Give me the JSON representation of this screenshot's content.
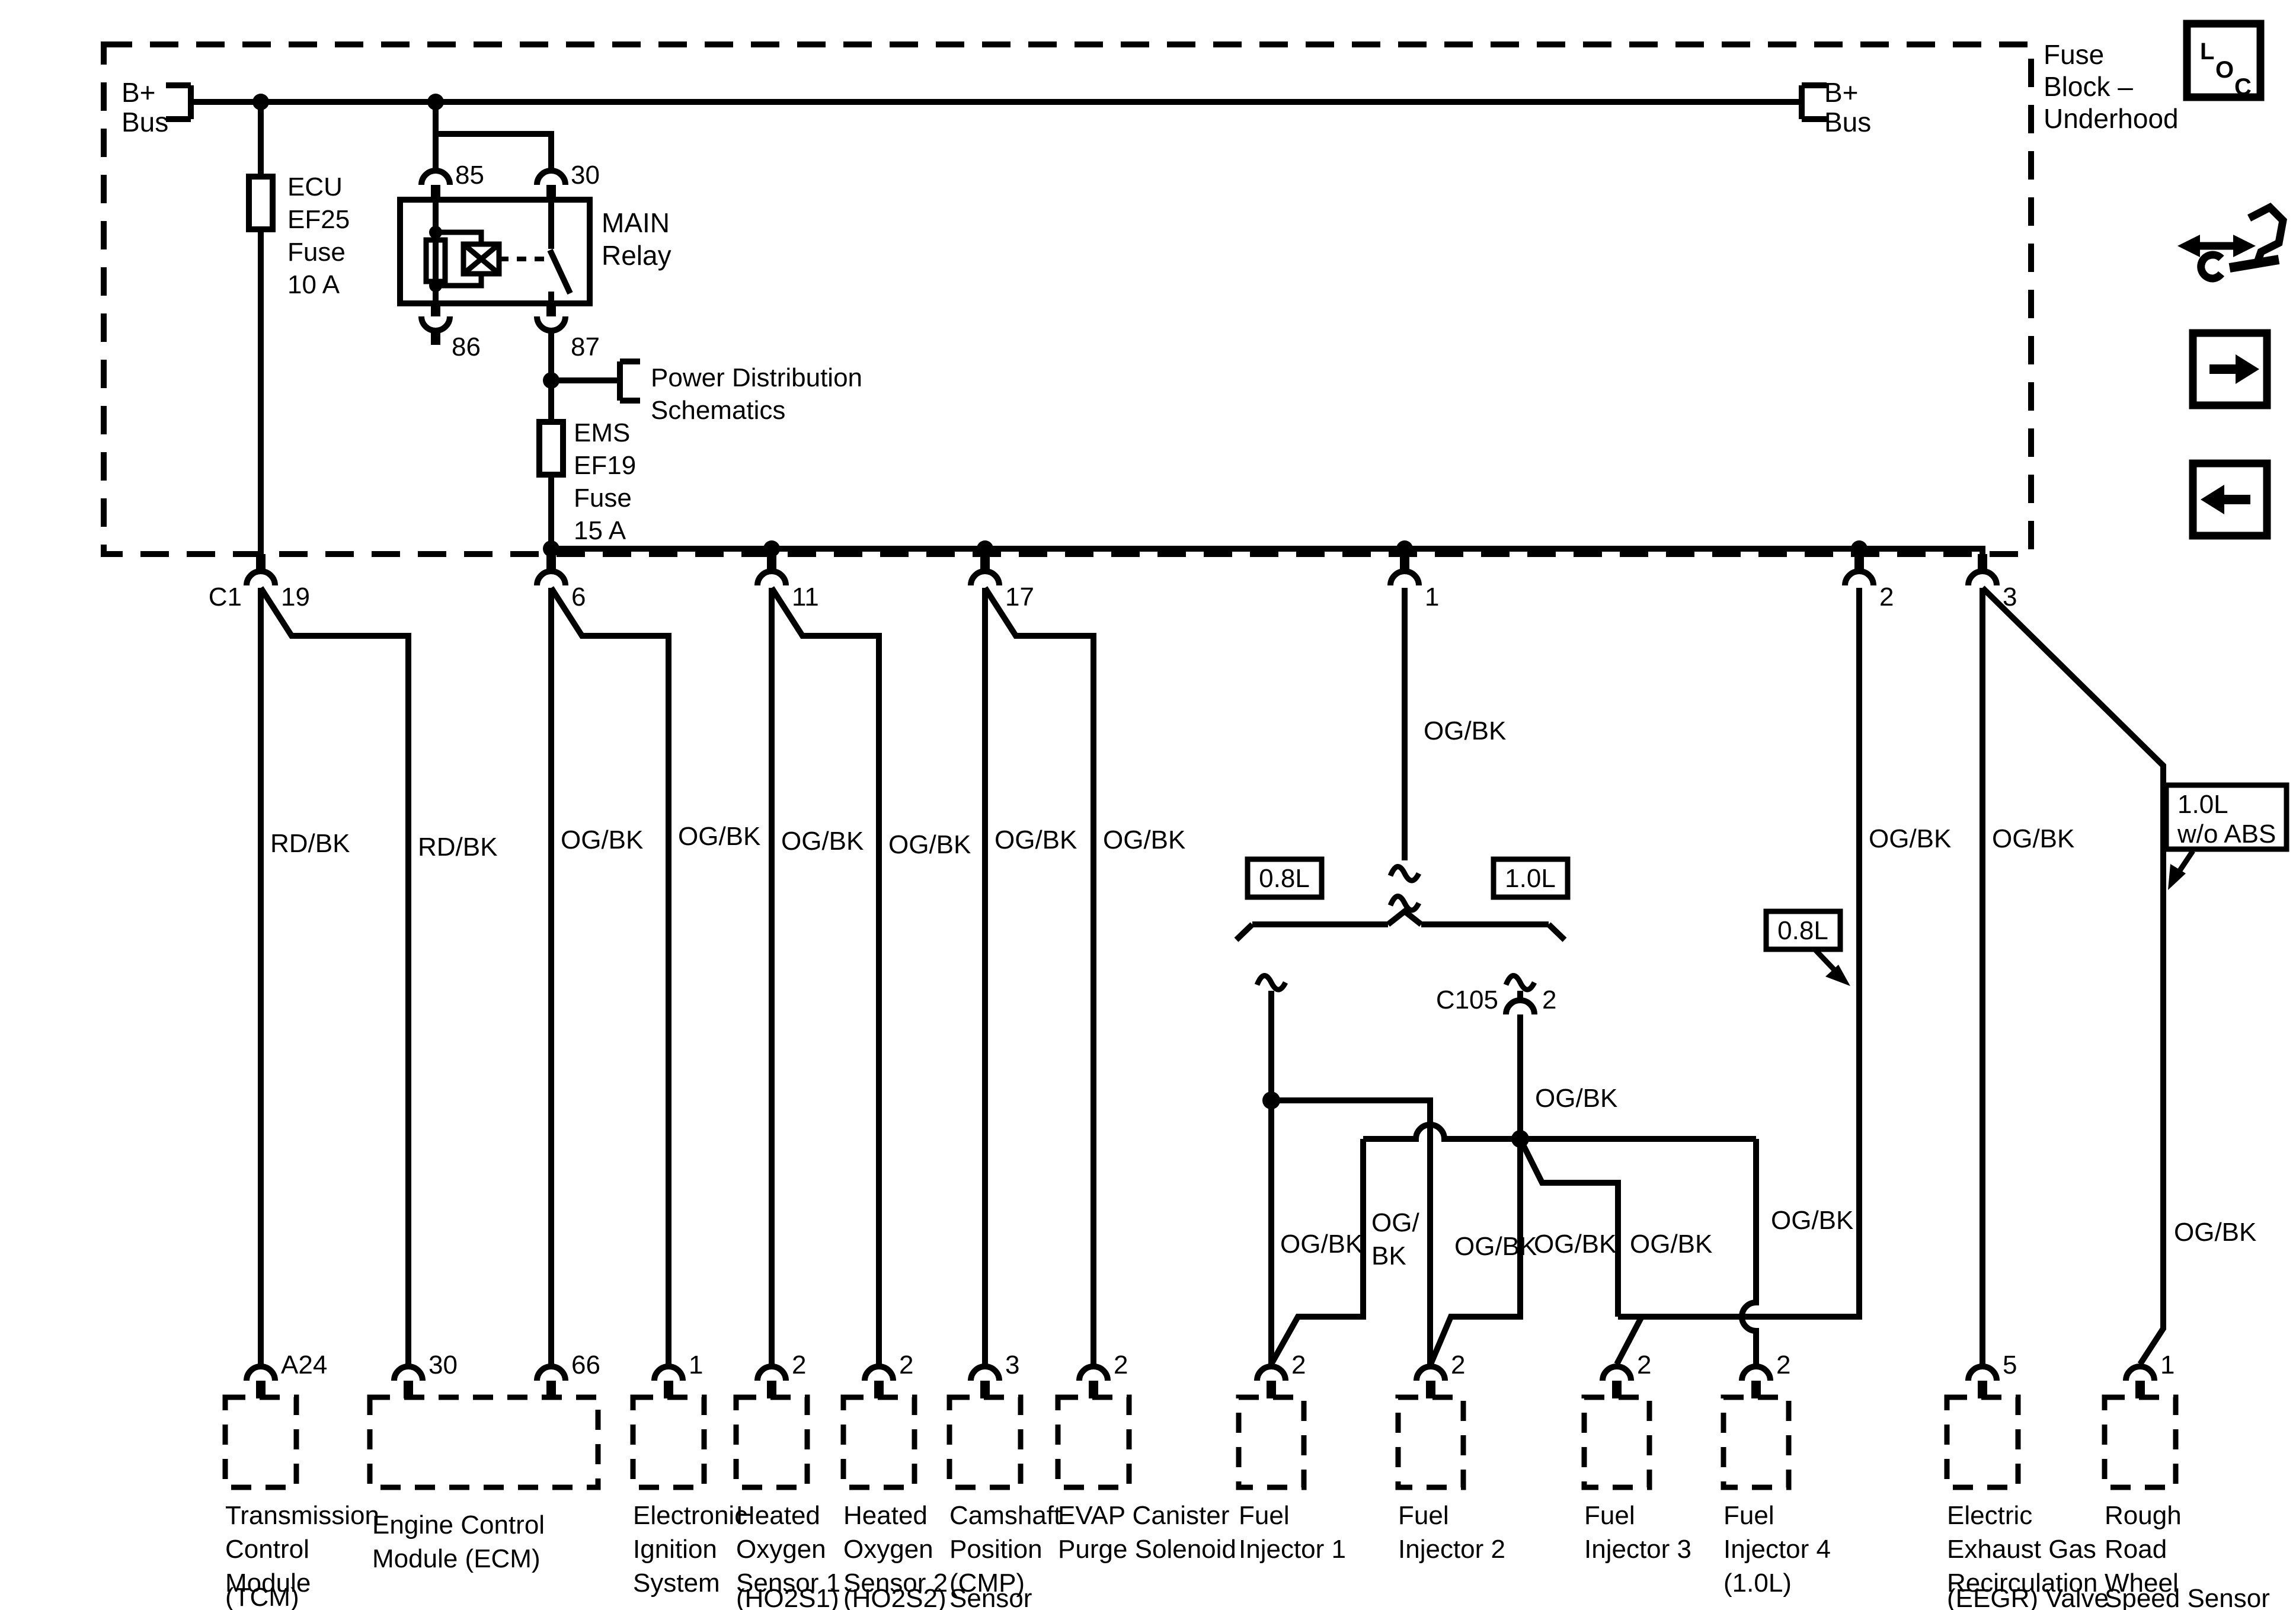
{
  "fuse_block": {
    "label": [
      "Fuse",
      "Block –",
      "Underhood"
    ]
  },
  "loc": {
    "letters": [
      "L",
      "O",
      "C"
    ]
  },
  "bus": {
    "left": [
      "B+",
      "Bus"
    ],
    "right": [
      "B+",
      "Bus"
    ]
  },
  "ecu_fuse": {
    "lines": [
      "ECU",
      "EF25",
      "Fuse",
      "10 A"
    ]
  },
  "ems_fuse": {
    "lines": [
      "EMS",
      "EF19",
      "Fuse",
      "15 A"
    ]
  },
  "relay": {
    "name": [
      "MAIN",
      "Relay"
    ],
    "pin85": "85",
    "pin30": "30",
    "pin86": "86",
    "pin87": "87"
  },
  "power_dist": {
    "lines": [
      "Power Distribution",
      "Schematics"
    ]
  },
  "fuse_block_connector": {
    "label": "C1",
    "pins": [
      "19",
      "6",
      "11",
      "17",
      "1",
      "2",
      "3"
    ]
  },
  "c105": {
    "label": "C105",
    "pin": "2"
  },
  "variants": {
    "v08": "0.8L",
    "v10": "1.0L",
    "v08_tag": "0.8L",
    "v10_abs": [
      "1.0L",
      "w/o ABS"
    ]
  },
  "wire_labels": [
    "RD/BK",
    "RD/BK",
    "OG/BK",
    "OG/BK",
    "OG/BK",
    "OG/BK",
    "OG/BK",
    "OG/BK",
    "OG/BK",
    "OG/BK",
    "OG/BK",
    "OG/",
    "BK",
    "OG/BK",
    "OG/BK",
    "OG/BK",
    "OG/BK",
    "OG/BK",
    "OG/BK",
    "OG/BK"
  ],
  "components": [
    {
      "lines": [
        "Transmission",
        "Control",
        "Module",
        "(TCM)"
      ],
      "pin": "A24"
    },
    {
      "lines": [
        "Engine Control",
        "Module (ECM)"
      ],
      "pin": "30",
      "pin2": "66"
    },
    {
      "lines": [
        "Electronic",
        "Ignition",
        "System"
      ],
      "pin": "1"
    },
    {
      "lines": [
        "Heated",
        "Oxygen",
        "Sensor 1",
        "(HO2S1)"
      ],
      "pin": "2"
    },
    {
      "lines": [
        "Heated",
        "Oxygen",
        "Sensor 2",
        "(HO2S2)"
      ],
      "pin": "2"
    },
    {
      "lines": [
        "Camshaft",
        "Position",
        "(CMP)",
        "Sensor"
      ],
      "pin": "3"
    },
    {
      "lines": [
        "EVAP Canister",
        "Purge Solenoid"
      ],
      "pin": "2"
    },
    {
      "lines": [
        "Fuel",
        "Injector 1"
      ],
      "pin": "2"
    },
    {
      "lines": [
        "Fuel",
        "Injector 2"
      ],
      "pin": "2"
    },
    {
      "lines": [
        "Fuel",
        "Injector 3"
      ],
      "pin": "2"
    },
    {
      "lines": [
        "Fuel",
        "Injector 4",
        "(1.0L)"
      ],
      "pin": "2"
    },
    {
      "lines": [
        "Electric",
        "Exhaust Gas",
        "Recirculation",
        "(EEGR) Valve"
      ],
      "pin": "5"
    },
    {
      "lines": [
        "Rough",
        "Road",
        "Wheel",
        "Speed Sensor"
      ],
      "pin": "1"
    }
  ]
}
